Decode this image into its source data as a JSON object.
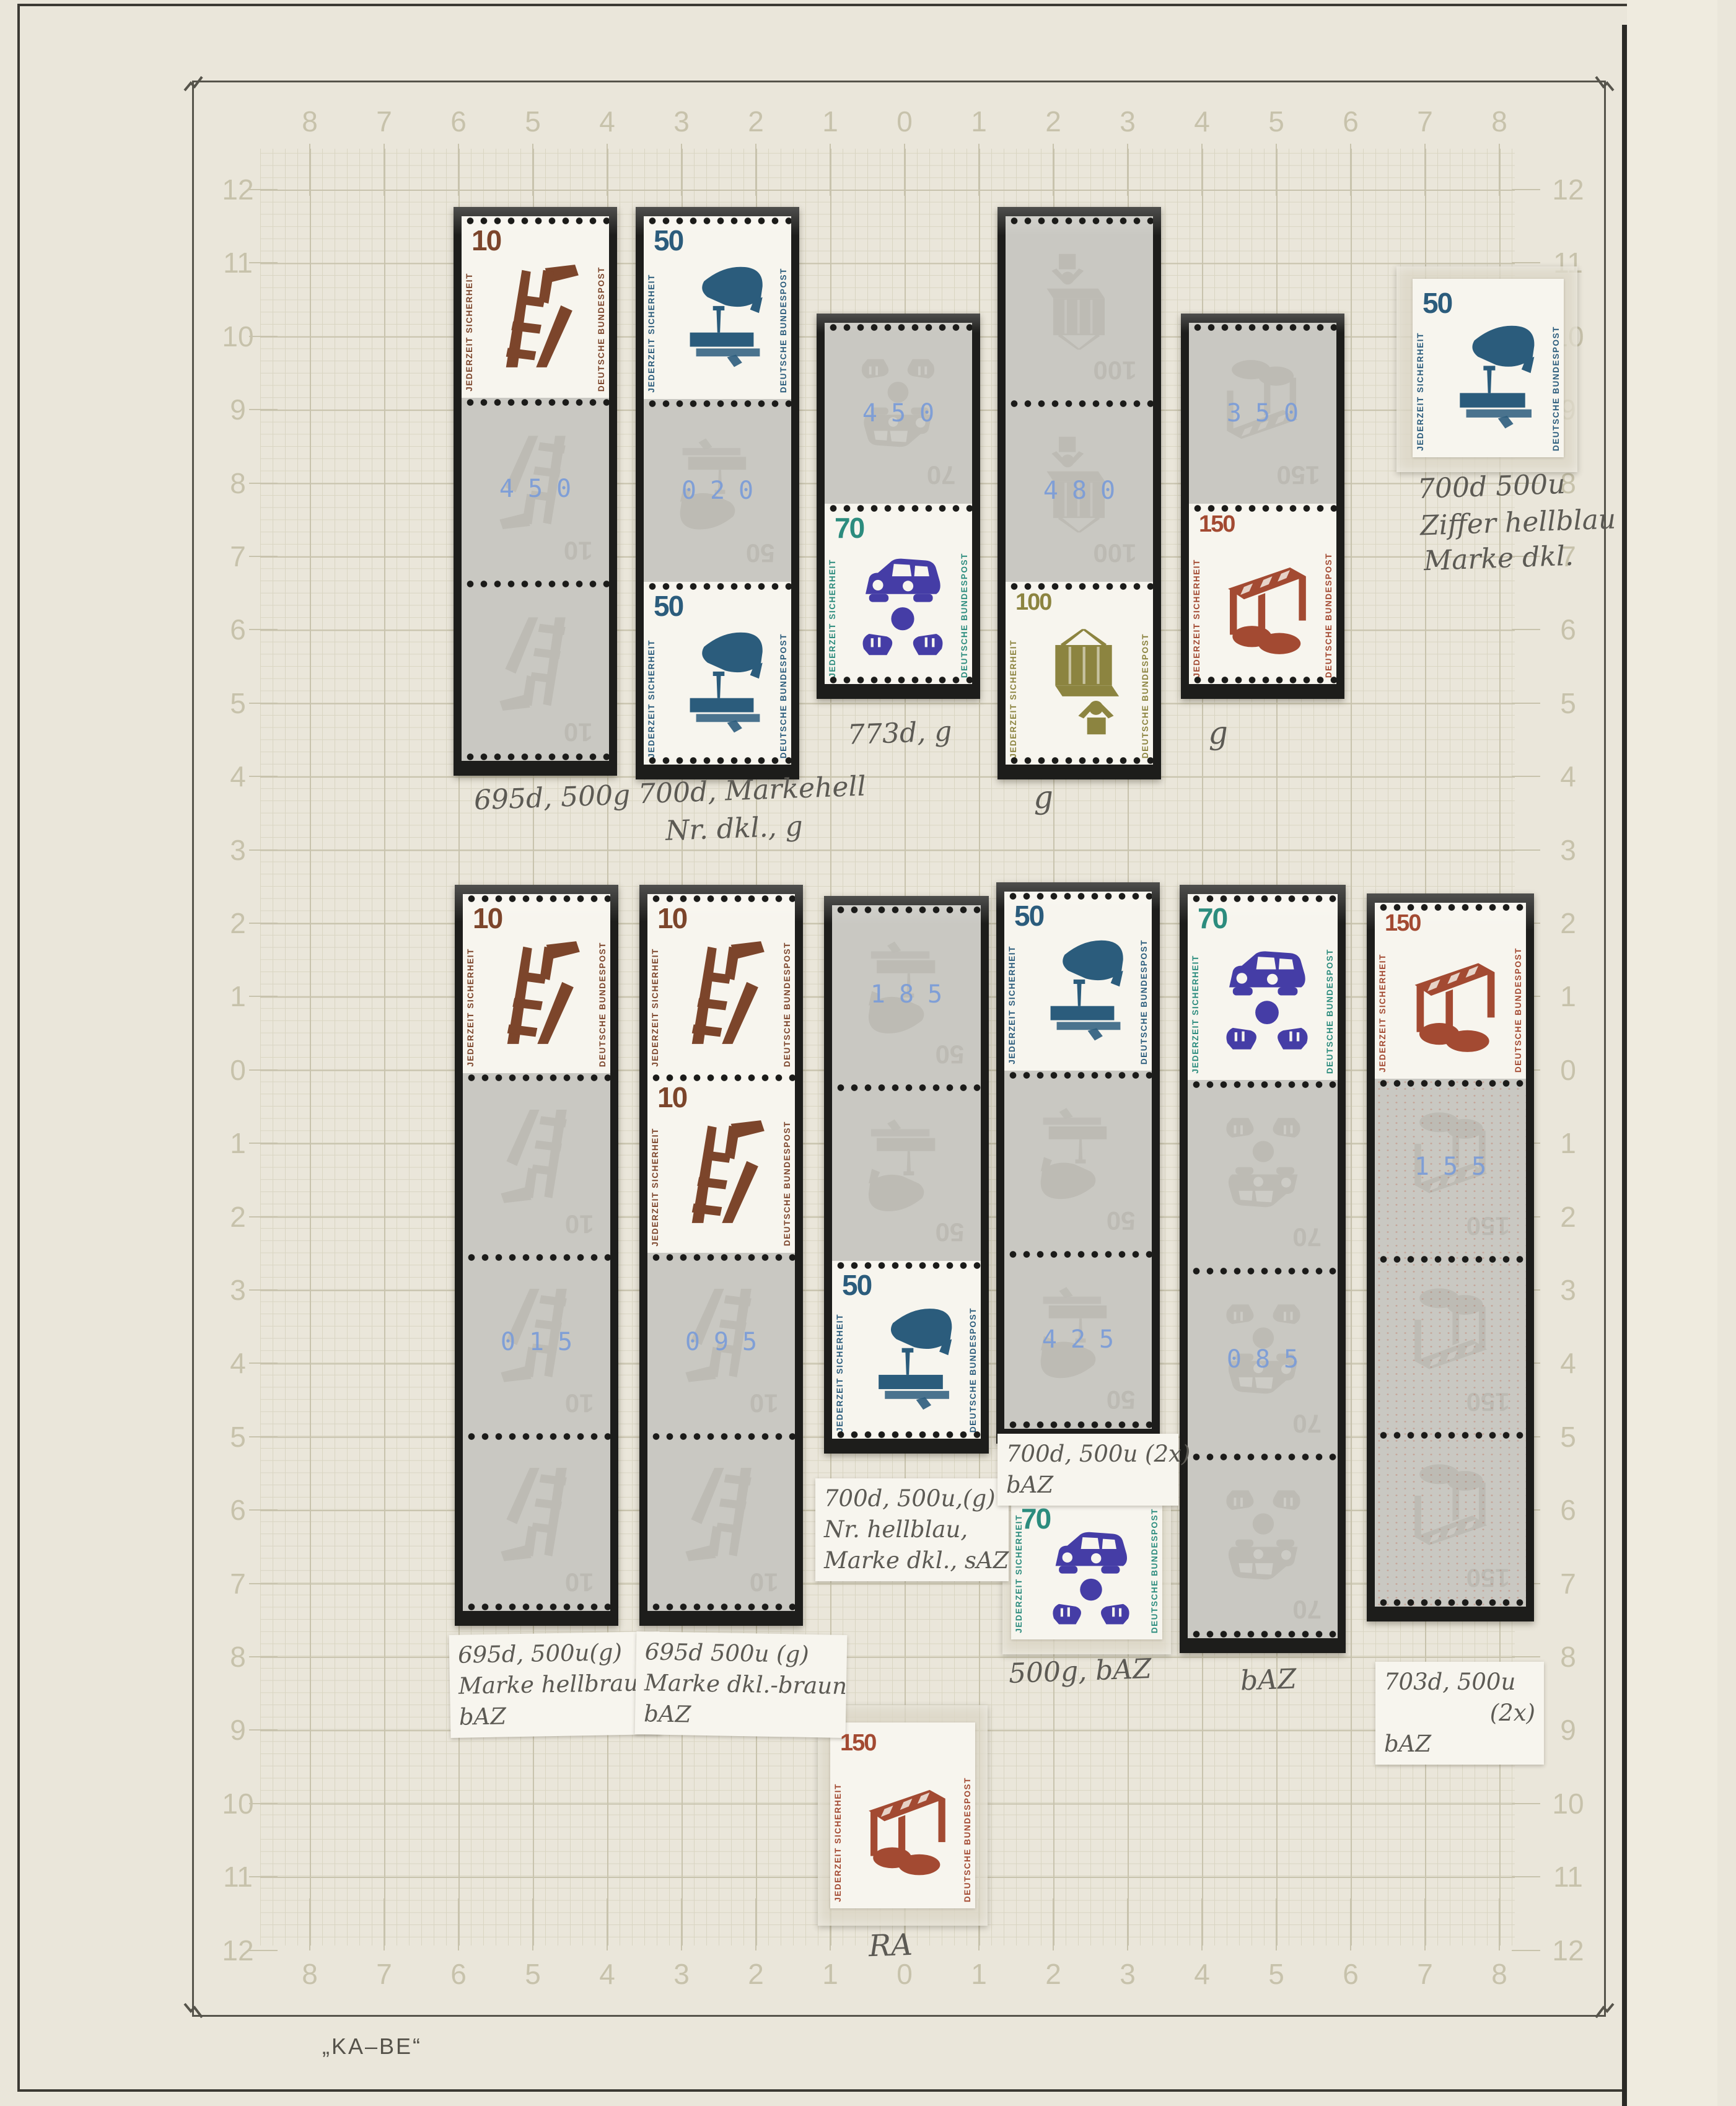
{
  "page": {
    "brand_mark": "„KA–BE“",
    "accent_colors": {
      "counting_number_blue": "#7a9cd8",
      "brown_10": "#7c452b",
      "blue_50": "#2b5c7c",
      "violet_70": "#453da6",
      "teal_70_text": "#2c8c7e",
      "olive_100": "#8c8440",
      "red_150": "#a34a32"
    }
  },
  "scales": {
    "top": [
      "8",
      "7",
      "6",
      "5",
      "4",
      "3",
      "2",
      "1",
      "0",
      "1",
      "2",
      "3",
      "4",
      "5",
      "6",
      "7",
      "8"
    ],
    "bottom": [
      "8",
      "7",
      "6",
      "5",
      "4",
      "3",
      "2",
      "1",
      "0",
      "1",
      "2",
      "3",
      "4",
      "5",
      "6",
      "7",
      "8"
    ],
    "left": [
      "12",
      "11",
      "10",
      "9",
      "8",
      "7",
      "6",
      "5",
      "4",
      "3",
      "2",
      "1",
      "0",
      "1",
      "2",
      "3",
      "4",
      "5",
      "6",
      "7",
      "8",
      "9",
      "10",
      "11",
      "12"
    ],
    "right": [
      "12",
      "11",
      "10",
      "9",
      "8",
      "7",
      "6",
      "5",
      "4",
      "3",
      "2",
      "1",
      "0",
      "1",
      "2",
      "3",
      "4",
      "5",
      "6",
      "7",
      "8",
      "9",
      "10",
      "11",
      "12"
    ]
  },
  "stamp_types": {
    "t10": {
      "value": "10",
      "motif": "broken-ladder",
      "left_text": "JEDERZEIT SICHERHEIT",
      "right_text": "DEUTSCHE BUNDESPOST",
      "motif_color": "#7c452b",
      "text_color": "#7c452b",
      "value_color": "#7c452b"
    },
    "t50": {
      "value": "50",
      "motif": "nail-in-board",
      "left_text": "JEDERZEIT SICHERHEIT",
      "right_text": "DEUTSCHE BUNDESPOST",
      "motif_color": "#2b5c7c",
      "text_color": "#2b5c7c",
      "value_color": "#2b5c7c"
    },
    "t70": {
      "value": "70",
      "motif": "traffic-accident",
      "left_text": "JEDERZEIT SICHERHEIT",
      "right_text": "DEUTSCHE BUNDESPOST",
      "motif_color": "#453da6",
      "text_color": "#2c8c7e",
      "value_color": "#2c8c7e"
    },
    "t100": {
      "value": "100",
      "motif": "hanging-load",
      "left_text": "JEDERZEIT SICHERHEIT",
      "right_text": "DEUTSCHE BUNDESPOST",
      "motif_color": "#8c8440",
      "text_color": "#8c8440",
      "value_color": "#8c8440"
    },
    "t150": {
      "value": "150",
      "motif": "construction-barrier",
      "left_text": "JEDERZEIT SICHERHEIT",
      "right_text": "DEUTSCHE BUNDESPOST",
      "motif_color": "#a34a32",
      "text_color": "#a34a32",
      "value_color": "#a34a32"
    }
  },
  "strips": {
    "strip-a": {
      "ghost": "t10",
      "fields": [
        {
          "stamp": "t10"
        },
        {
          "number": "450"
        },
        {}
      ]
    },
    "strip-b": {
      "ghost": "t50",
      "fields": [
        {
          "stamp": "t50"
        },
        {
          "number": "020"
        },
        {
          "stamp": "t50"
        }
      ]
    },
    "strip-c": {
      "ghost": "t70",
      "fields": [
        {
          "number": "450"
        },
        {
          "stamp": "t70"
        }
      ]
    },
    "strip-d": {
      "ghost": "t100",
      "fields": [
        {},
        {
          "number": "480"
        },
        {
          "stamp": "t100"
        }
      ]
    },
    "strip-e": {
      "ghost": "t150",
      "fields": [
        {
          "number": "350"
        },
        {
          "stamp": "t150"
        }
      ]
    },
    "strip-g": {
      "ghost": "t10",
      "fields": [
        {
          "stamp": "t10"
        },
        {},
        {
          "number": "015"
        },
        {}
      ]
    },
    "strip-h": {
      "ghost": "t10",
      "fields": [
        {
          "stamp": "t10"
        },
        {
          "stamp": "t10"
        },
        {
          "number": "095"
        },
        {}
      ]
    },
    "strip-i": {
      "ghost": "t50",
      "fields": [
        {
          "number": "185"
        },
        {},
        {
          "stamp": "t50"
        }
      ]
    },
    "strip-j": {
      "ghost": "t50",
      "fields": [
        {
          "stamp": "t50"
        },
        {},
        {
          "number": "425"
        }
      ]
    },
    "strip-k5": {
      "ghost": "t70",
      "fields": [
        {
          "stamp": "t70"
        },
        {},
        {
          "number": "085"
        },
        {}
      ]
    },
    "strip-k6": {
      "ghost": "t150",
      "speckle": true,
      "fields": [
        {
          "stamp": "t150"
        },
        {
          "number": "155"
        },
        {},
        {}
      ]
    }
  },
  "singles": {
    "single-f": {
      "stamp": "t50"
    },
    "single-k": {
      "stamp": "t70"
    },
    "single-ra": {
      "stamp": "t150"
    }
  },
  "annotations": {
    "a1": "695d, 500g",
    "a2_l1": "700d, Markehell",
    "a2_l2": "Nr. dkl., g",
    "a3": "773d, g",
    "a4": "g",
    "a5": "g",
    "a6_l1": "700d  500u",
    "a6_l2": "Ziffer hellblau",
    "a6_l3": "Marke dkl.",
    "l1_l1": "695d, 500u(g)",
    "l1_l2": "Marke hellbraun",
    "l1_l3": "bAZ",
    "l2_l1": "695d  500u (g)",
    "l2_l2": "Marke dkl.-braun",
    "l2_l3": "bAZ",
    "l3_l1": "700d, 500u,(g)",
    "l3_l2": "Nr. hellblau,",
    "l3_l3": "Marke dkl., sAZ",
    "l4_l1": "700d, 500u (2x)",
    "l4_l2": "bAZ",
    "a7": "bAZ",
    "l6_l1": "703d, 500u",
    "l6_l2": "(2x)",
    "l6_l3": "bAZ",
    "a8": "500g, bAZ",
    "a9": "RA"
  }
}
